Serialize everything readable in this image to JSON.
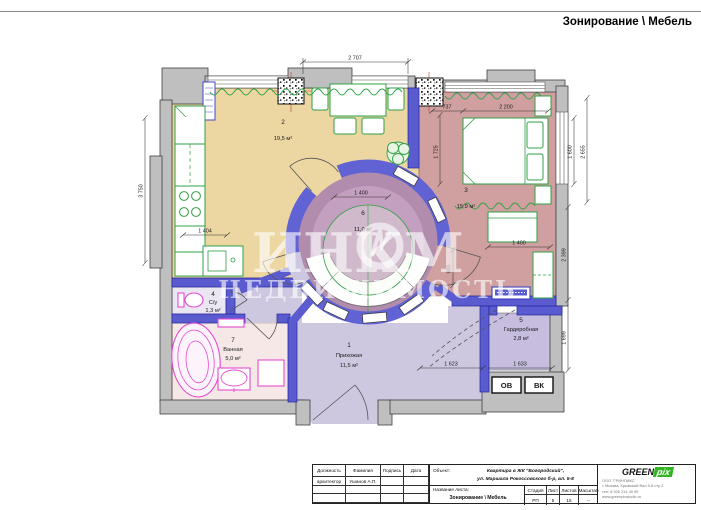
{
  "header": {
    "title": "Зонирование \\ Мебель"
  },
  "watermark": {
    "part1": "ИНК",
    "part2": "М",
    "line2": "НЕДВИЖИМОСТЬ"
  },
  "rooms": {
    "hallway": {
      "number": "1",
      "name": "Прихожая",
      "area": "11,5 м²"
    },
    "kitchen": {
      "number": "2",
      "area": "19,5 м²"
    },
    "bedroom": {
      "number": "3",
      "area": "15,9 м²"
    },
    "wc": {
      "number": "4",
      "name": "С/у",
      "area": "1,3 м²"
    },
    "wardrobe": {
      "number": "5",
      "name": "Гардеробная",
      "area": "2,8 м²"
    },
    "lounge": {
      "number": "6",
      "area": "11,0 м²"
    },
    "bathroom": {
      "number": "7",
      "name": "Ванная",
      "area": "5,0 м²"
    }
  },
  "shafts": {
    "heating": "ОВ",
    "water": "ВК"
  },
  "dims": {
    "top": "2 707",
    "bed_offset": "737",
    "bed_width": "2 200",
    "bed_len": "1 725",
    "win_in": "1 600",
    "win_out": "2 655",
    "right_low": "2 399",
    "ward_h": "1 699",
    "kit_wall": "3 750",
    "kit_count": "1 404",
    "lounge_open": "1 400",
    "sofa_w": "1 400",
    "door_w": "900",
    "hall_open": "1 623",
    "ward_w": "1 633"
  },
  "titleblock": {
    "columns": {
      "position": "Должность",
      "surname": "Фамилия",
      "signature": "Подпись",
      "date": "Дата"
    },
    "rows": [
      {
        "position": "архитектор",
        "surname": "Ушанов А.П."
      }
    ],
    "object_label": "Объект:",
    "object_line1": "Квартира в ЖК \"Богородский\",",
    "object_line2": "ул. Маршала Рокоссовского б-р, вл. 5-8",
    "sheet_label": "Название листа:",
    "sheet_name": "Зонирование \\ Мебель",
    "stage_label": "Стадия",
    "sheet_col_label": "Лист",
    "sheets_label": "Листов",
    "scale_label": "Масштаб",
    "stage": "РП",
    "sheet": "5",
    "sheets": "15",
    "scale": "--"
  },
  "logo": {
    "brand_black": "GREEN",
    "brand_white": "pix",
    "company": "ООО \"ГРИНПИКС\"",
    "address": "г. Москва, Крымский Вал 5-8 стр 2",
    "phone": "тел: 8 926 214 49 99",
    "website": "www.greenpixstudio.ru"
  },
  "colors": {
    "kitchen_floor": "#ecd7a2",
    "bedroom_floor": "#d0a0a0",
    "lounge_floor": "#b18cad",
    "hall_floor": "#cdc8e0",
    "wardrobe_floor": "#c6bddf",
    "bathroom_floor": "#f6e8e6",
    "wc_floor": "#eae6f2",
    "wall_blue": "#5b5bd0",
    "wall_gray": "#bfbfbf",
    "furniture_green": "#2fa045",
    "fixture_magenta": "#e34bd0",
    "logo_green": "#35b426"
  }
}
